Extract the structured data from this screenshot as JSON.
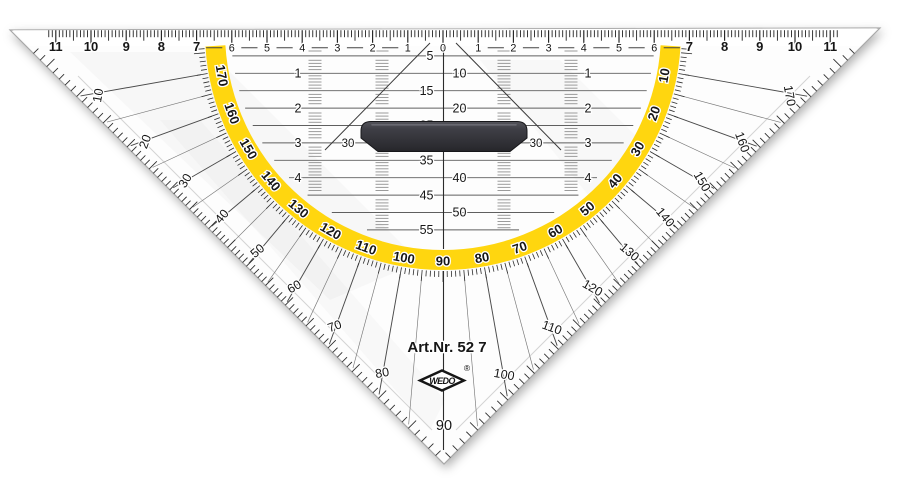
{
  "branding": {
    "art_no": "Art.Nr. 52 7",
    "logo": "WEDO",
    "registered": "®"
  },
  "colors": {
    "band_yellow": "#FFD60F",
    "ink": "#161616",
    "grid_line": "#5f5f5f",
    "ladder_gray": "#9b9b9b",
    "handle_dark": "#3c3c42",
    "handle_edge": "#17171a",
    "plastic_edge": "#a8a8a8",
    "body_white": "#fdfdfd"
  },
  "ruler": {
    "unit": "cm",
    "max": 11,
    "numbers": [
      0,
      1,
      2,
      3,
      4,
      5,
      6,
      7,
      8,
      9,
      10,
      11
    ]
  },
  "protractor": {
    "outer_left": [
      10,
      20,
      30,
      40,
      50,
      60,
      70,
      80
    ],
    "outer_right": [
      100,
      110,
      120,
      130,
      140,
      150,
      160,
      170
    ],
    "band_labels": [
      10,
      20,
      30,
      40,
      50,
      60,
      70,
      80,
      90,
      100,
      110,
      120,
      130,
      140,
      150,
      160,
      170
    ],
    "vertex_label": "90"
  },
  "grid": {
    "cm_rows": [
      1,
      2,
      3,
      4
    ],
    "mm_labels": [
      5,
      10,
      15,
      20,
      25,
      35,
      40,
      45,
      50,
      55
    ],
    "handle_side_labels": [
      "30",
      "30"
    ]
  }
}
